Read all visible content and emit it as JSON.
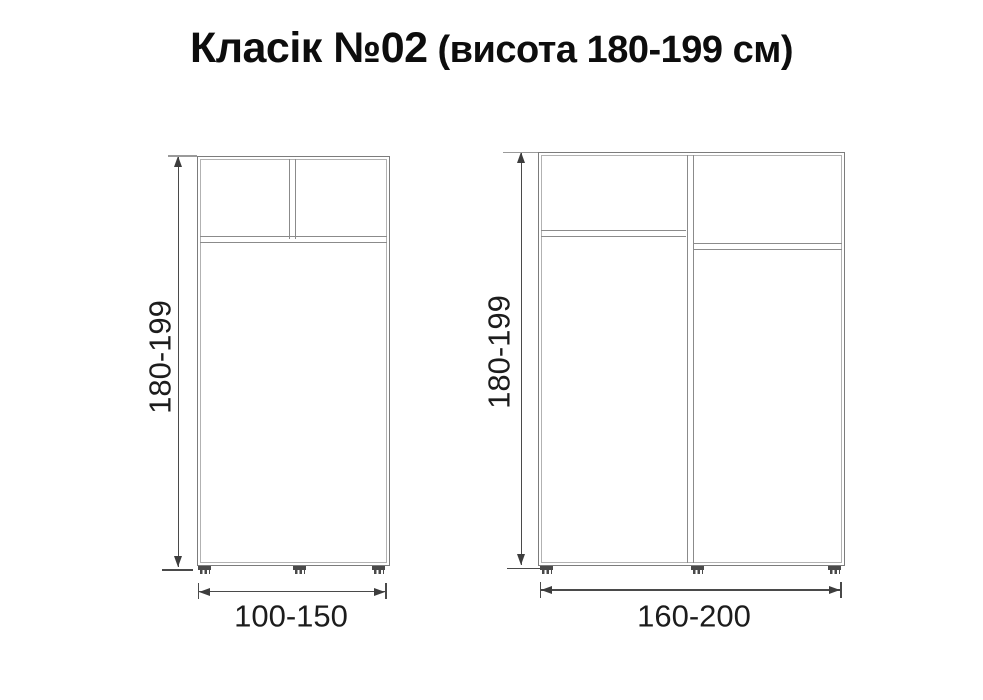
{
  "title": {
    "main": "Класік №02",
    "sub": "(висота 180-199 см)"
  },
  "left_cabinet": {
    "height_label": "180-199",
    "width_label": "100-150"
  },
  "right_cabinet": {
    "height_label": "180-199",
    "width_label": "160-200"
  },
  "colors": {
    "background": "#ffffff",
    "cabinet_line": "#7c7c7c",
    "cabinet_line_light": "#b2b2b2",
    "divider_line": "#8b8b8b",
    "dimension_line": "#4a4a4a",
    "arrow": "#3d3d3d",
    "text": "#111111"
  }
}
